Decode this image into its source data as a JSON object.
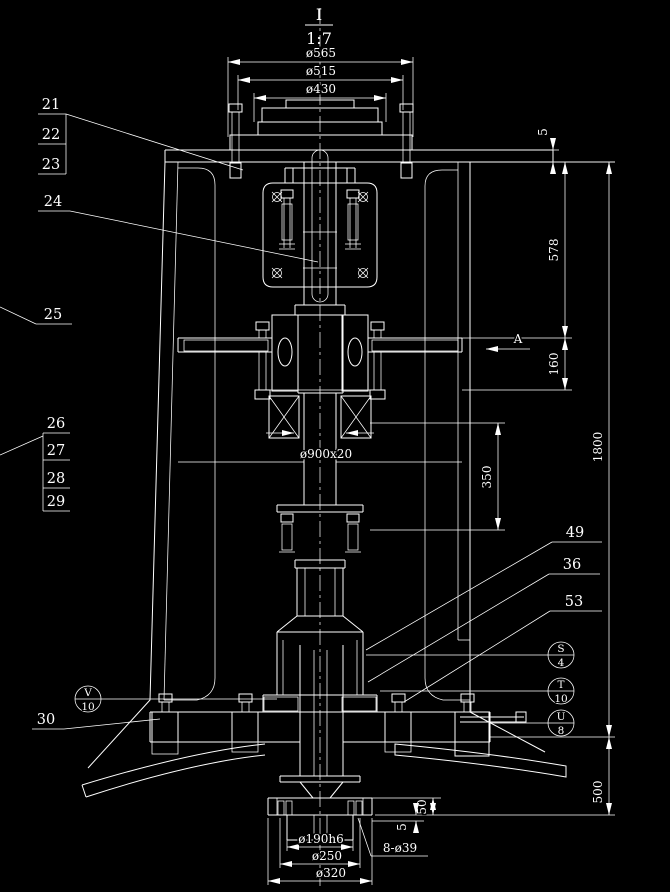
{
  "colors": {
    "background": "#000000",
    "line": "#ffffff"
  },
  "view": {
    "label": "I",
    "scale": "1:7"
  },
  "dims": {
    "d565": "ø565",
    "d515": "ø515",
    "d430": "ø430",
    "plate5": "5",
    "d578": "578",
    "d160": "160",
    "d1800": "1800",
    "d350": "350",
    "d900": "ø900x20",
    "d500": "500",
    "d50": "50",
    "d5b": "5",
    "d190": "ø190h6",
    "d250": "ø250",
    "d320": "ø320",
    "d839": "8-ø39"
  },
  "section": {
    "arrow_label": "A"
  },
  "callouts": {
    "c21": "21",
    "c22": "22",
    "c23": "23",
    "c24": "24",
    "c25": "25",
    "c26": "26",
    "c27": "27",
    "c28": "28",
    "c29": "29",
    "c30": "30",
    "c49": "49",
    "c36": "36",
    "c53": "53"
  },
  "finish_symbols": {
    "v10": {
      "top": "V",
      "bottom": "10"
    },
    "s4": {
      "top": "S",
      "bottom": "4"
    },
    "t10": {
      "top": "T",
      "bottom": "10"
    },
    "u8": {
      "top": "U",
      "bottom": "8"
    }
  }
}
